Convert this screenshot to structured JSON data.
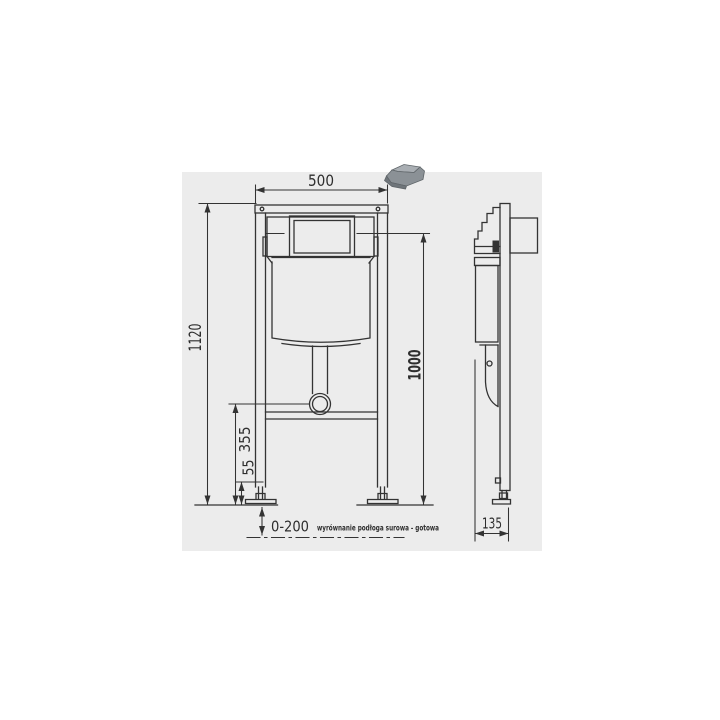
{
  "drawing": {
    "front": {
      "width": "500",
      "height_total": "1120",
      "height_flush_center": "1000",
      "height_outlet": "355",
      "height_foot": "55",
      "floor_adjust_range": "0-200",
      "floor_note": "wyrównanie podłoga surowa - gotowa"
    },
    "side": {
      "depth": "135"
    }
  },
  "colors": {
    "line": "#333333",
    "text": "#2e2e2e",
    "panel_bg": "#ececec",
    "bracket_light": "#a9aeb3",
    "bracket_mid": "#8b9196",
    "bracket_dark": "#6f757a",
    "bracket_stroke": "#5f6569"
  }
}
